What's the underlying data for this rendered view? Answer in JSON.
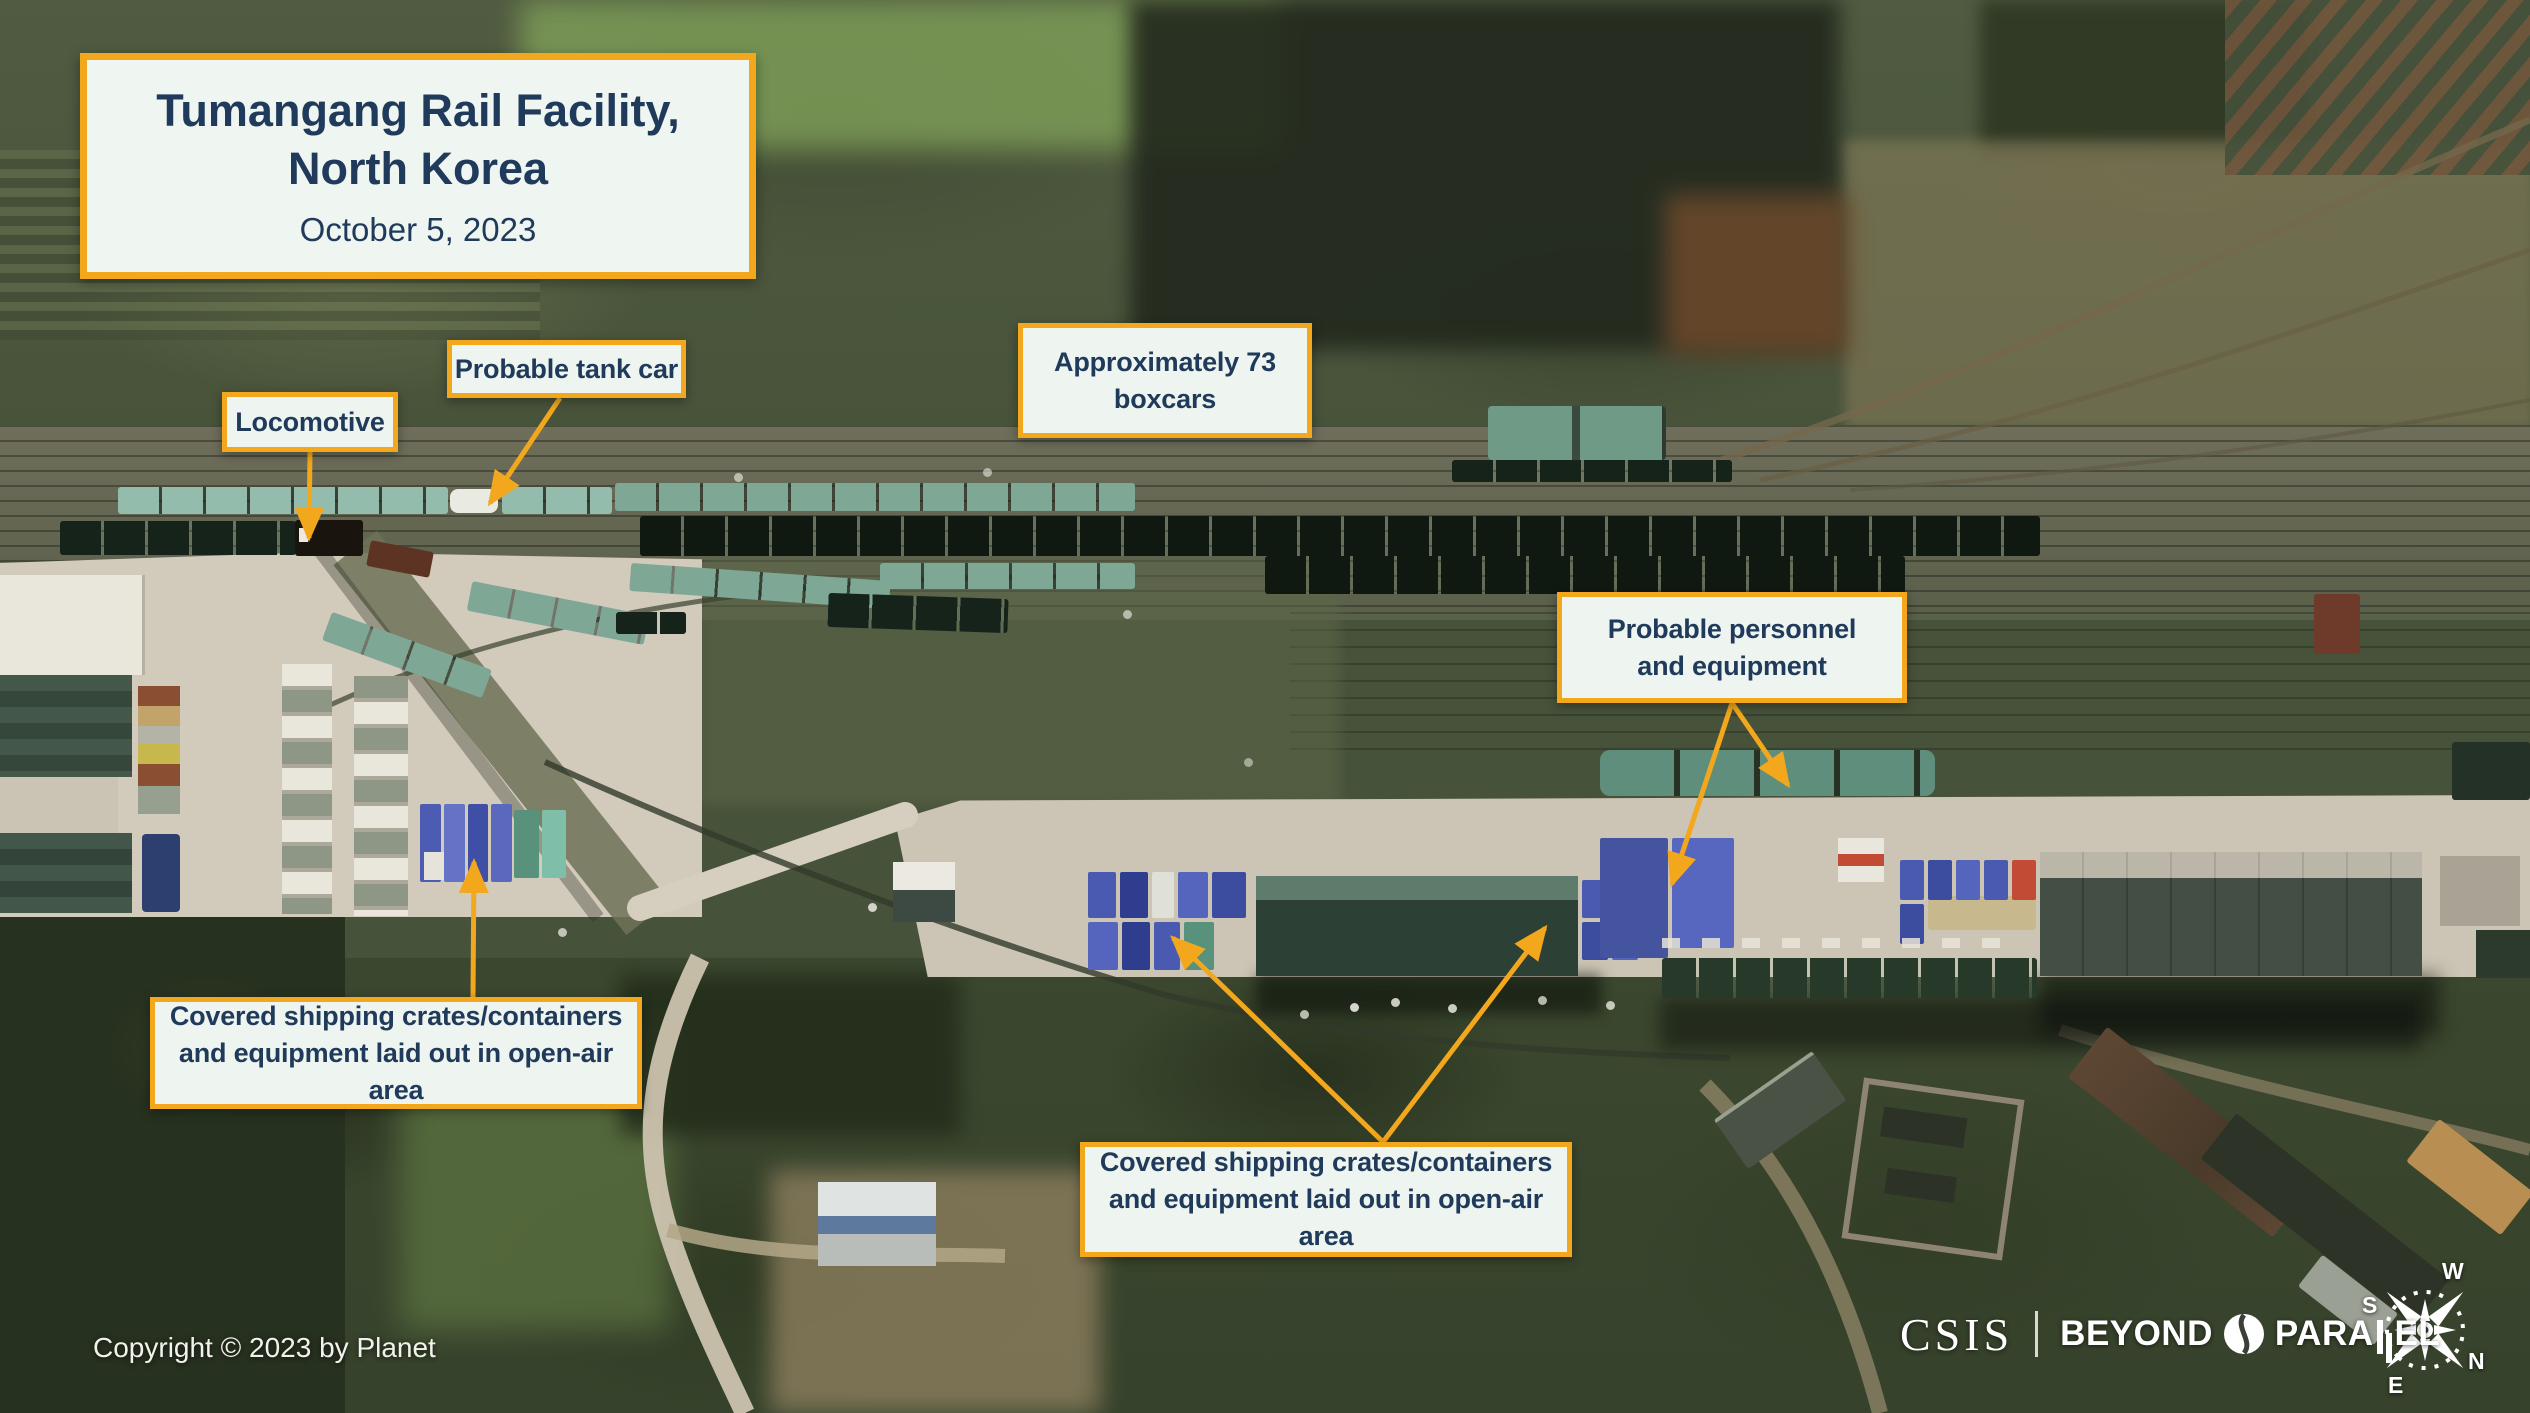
{
  "title_card": {
    "line1": "Tumangang Rail Facility,",
    "line2": "North Korea",
    "date": "October 5, 2023"
  },
  "labels": {
    "locomotive": "Locomotive",
    "tank_car": "Probable tank car",
    "boxcars": {
      "line1": "Approximately 73",
      "line2": "boxcars"
    },
    "personnel": {
      "line1": "Probable personnel",
      "line2": "and equipment"
    },
    "crates_left": {
      "line1": "Covered shipping crates/containers",
      "line2": "and equipment laid out in open-air area"
    },
    "crates_center": {
      "line1": "Covered shipping crates/containers",
      "line2": "and equipment laid out in open-air area"
    }
  },
  "footer": {
    "copyright": "Copyright © 2023 by Planet"
  },
  "branding": {
    "csis": "CSIS",
    "beyond": "BEYOND",
    "para": "PARA",
    "el": "EL"
  },
  "compass": {
    "n": "N",
    "s": "S",
    "e": "E",
    "w": "W"
  },
  "colors": {
    "annotation_border": "#F2A71C",
    "annotation_bg": "#EEF4EF",
    "annotation_text": "#1F3A5A",
    "arrow": "#F2A71C"
  }
}
